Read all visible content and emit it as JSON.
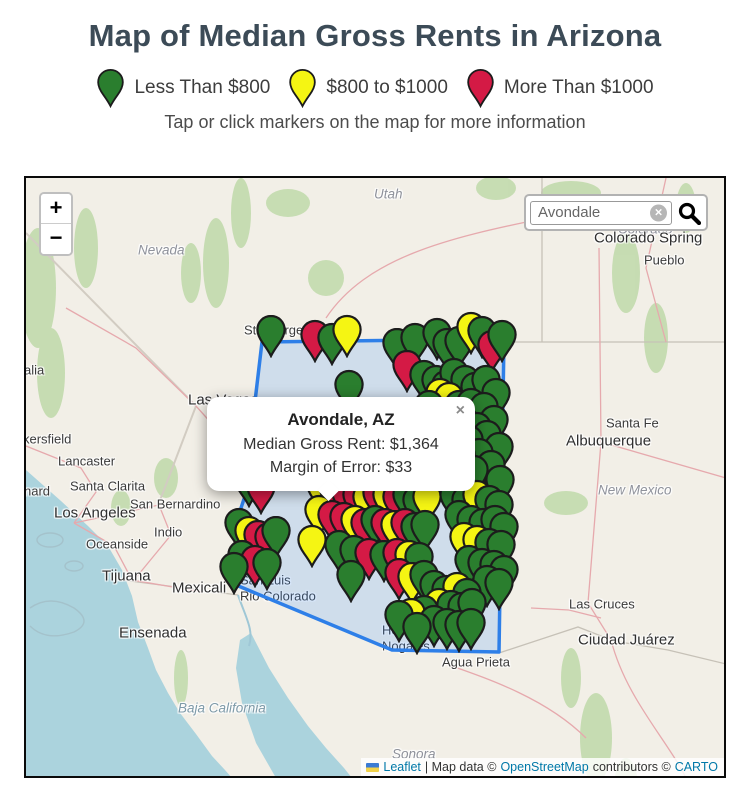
{
  "page": {
    "title": "Map of Median Gross Rents in Arizona",
    "subtitle": "Tap or click markers on the map for more information"
  },
  "legend": {
    "items": [
      {
        "label": "Less Than $800",
        "color": "#2a7e2e"
      },
      {
        "label": "$800 to $1000",
        "color": "#f5f513"
      },
      {
        "label": "More Than $1000",
        "color": "#d41a45"
      }
    ]
  },
  "map": {
    "controls": {
      "zoom_in": "+",
      "zoom_out": "−"
    },
    "search": {
      "value": "Avondale",
      "clear_icon": "×"
    },
    "popup": {
      "title": "Avondale, AZ",
      "line1": "Median Gross Rent: $1,364",
      "line2": "Margin of Error: $33",
      "close": "×"
    },
    "attribution": {
      "leaflet": "Leaflet",
      "map_data": "| Map data ©",
      "osm": "OpenStreetMap",
      "contributors": "contributors ©",
      "carto": "CARTO"
    },
    "boundary_color": "#2e7fe8",
    "marker_colors": {
      "g": "#2a7e2e",
      "y": "#f5f513",
      "r": "#d41a45"
    },
    "labels": [
      {
        "t": "Utah",
        "x": 348,
        "y": 16,
        "cls": "state"
      },
      {
        "t": "Nevada",
        "x": 112,
        "y": 72,
        "cls": "state"
      },
      {
        "t": "Colorado",
        "x": 592,
        "y": 51,
        "cls": "state"
      },
      {
        "t": "Colorado Spring",
        "x": 568,
        "y": 60,
        "cls": "citybig"
      },
      {
        "t": "Pueblo",
        "x": 618,
        "y": 82,
        "cls": "city"
      },
      {
        "t": "Santa Fe",
        "x": 580,
        "y": 245,
        "cls": "city"
      },
      {
        "t": "Albuquerque",
        "x": 540,
        "y": 263,
        "cls": "citybig"
      },
      {
        "t": "New Mexico",
        "x": 572,
        "y": 312,
        "cls": "state"
      },
      {
        "t": "Las Cruces",
        "x": 543,
        "y": 426,
        "cls": "city"
      },
      {
        "t": "Ciudad Juárez",
        "x": 552,
        "y": 462,
        "cls": "citybig"
      },
      {
        "t": "Agua Prieta",
        "x": 416,
        "y": 484,
        "cls": "city"
      },
      {
        "t": "Heroica",
        "x": 356,
        "y": 452,
        "cls": "city"
      },
      {
        "t": "Nogales",
        "x": 356,
        "y": 468,
        "cls": "city"
      },
      {
        "t": "San Luis",
        "x": 214,
        "y": 402,
        "cls": "city"
      },
      {
        "t": "Rio Colorado",
        "x": 214,
        "y": 418,
        "cls": "city"
      },
      {
        "t": "Mexicali",
        "x": 146,
        "y": 410,
        "cls": "citybig"
      },
      {
        "t": "Tijuana",
        "x": 76,
        "y": 398,
        "cls": "citybig"
      },
      {
        "t": "Ensenada",
        "x": 93,
        "y": 455,
        "cls": "citybig"
      },
      {
        "t": "Baja California",
        "x": 152,
        "y": 530,
        "cls": "area"
      },
      {
        "t": "Sonora",
        "x": 366,
        "y": 576,
        "cls": "state"
      },
      {
        "t": "Los Angeles",
        "x": 28,
        "y": 335,
        "cls": "citybig"
      },
      {
        "t": "San Bernardino",
        "x": 104,
        "y": 326,
        "cls": "city"
      },
      {
        "t": "Santa Clarita",
        "x": 44,
        "y": 308,
        "cls": "city"
      },
      {
        "t": "Lancaster",
        "x": 32,
        "y": 283,
        "cls": "city"
      },
      {
        "t": "kersfield",
        "x": -3,
        "y": 261,
        "cls": "city"
      },
      {
        "t": "nard",
        "x": -2,
        "y": 313,
        "cls": "city"
      },
      {
        "t": "Indio",
        "x": 128,
        "y": 354,
        "cls": "city"
      },
      {
        "t": "Oceanside",
        "x": 60,
        "y": 366,
        "cls": "city"
      },
      {
        "t": "alia",
        "x": -2,
        "y": 192,
        "cls": "city"
      },
      {
        "t": "Las Vegas",
        "x": 162,
        "y": 222,
        "cls": "citybig"
      },
      {
        "t": "St George",
        "x": 218,
        "y": 152,
        "cls": "city"
      }
    ],
    "markers": [
      [
        245,
        179,
        "g"
      ],
      [
        289,
        184,
        "r"
      ],
      [
        306,
        187,
        "g"
      ],
      [
        321,
        179,
        "y"
      ],
      [
        371,
        192,
        "g"
      ],
      [
        389,
        187,
        "g"
      ],
      [
        411,
        182,
        "g"
      ],
      [
        421,
        192,
        "g"
      ],
      [
        433,
        190,
        "g"
      ],
      [
        445,
        176,
        "y"
      ],
      [
        456,
        180,
        "g"
      ],
      [
        466,
        194,
        "r"
      ],
      [
        476,
        184,
        "g"
      ],
      [
        381,
        214,
        "r"
      ],
      [
        398,
        224,
        "g"
      ],
      [
        410,
        229,
        "g"
      ],
      [
        420,
        234,
        "g"
      ],
      [
        428,
        222,
        "g"
      ],
      [
        439,
        229,
        "g"
      ],
      [
        449,
        236,
        "g"
      ],
      [
        460,
        229,
        "g"
      ],
      [
        470,
        242,
        "g"
      ],
      [
        414,
        242,
        "y"
      ],
      [
        423,
        246,
        "y"
      ],
      [
        403,
        254,
        "g"
      ],
      [
        433,
        254,
        "g"
      ],
      [
        445,
        252,
        "g"
      ],
      [
        458,
        256,
        "g"
      ],
      [
        323,
        234,
        "g"
      ],
      [
        468,
        269,
        "g"
      ],
      [
        428,
        269,
        "g"
      ],
      [
        440,
        272,
        "g"
      ],
      [
        451,
        276,
        "g"
      ],
      [
        413,
        269,
        "g"
      ],
      [
        461,
        284,
        "g"
      ],
      [
        443,
        289,
        "g"
      ],
      [
        425,
        286,
        "g"
      ],
      [
        473,
        296,
        "g"
      ],
      [
        453,
        302,
        "g"
      ],
      [
        435,
        304,
        "g"
      ],
      [
        465,
        314,
        "g"
      ],
      [
        448,
        319,
        "g"
      ],
      [
        474,
        329,
        "g"
      ],
      [
        223,
        329,
        "g"
      ],
      [
        235,
        336,
        "r"
      ],
      [
        213,
        372,
        "g"
      ],
      [
        223,
        380,
        "y"
      ],
      [
        232,
        384,
        "r"
      ],
      [
        243,
        386,
        "r"
      ],
      [
        250,
        380,
        "g"
      ],
      [
        216,
        404,
        "g"
      ],
      [
        229,
        409,
        "r"
      ],
      [
        241,
        412,
        "g"
      ],
      [
        208,
        416,
        "g"
      ],
      [
        303,
        319,
        "g"
      ],
      [
        315,
        316,
        "r"
      ],
      [
        325,
        322,
        "r"
      ],
      [
        335,
        324,
        "r"
      ],
      [
        343,
        329,
        "r"
      ],
      [
        353,
        322,
        "g"
      ],
      [
        363,
        326,
        "r"
      ],
      [
        373,
        322,
        "y"
      ],
      [
        383,
        329,
        "g"
      ],
      [
        391,
        324,
        "g"
      ],
      [
        401,
        322,
        "r"
      ],
      [
        411,
        329,
        "g"
      ],
      [
        295,
        334,
        "y"
      ],
      [
        308,
        339,
        "r"
      ],
      [
        320,
        342,
        "r"
      ],
      [
        331,
        344,
        "r"
      ],
      [
        341,
        346,
        "y"
      ],
      [
        351,
        342,
        "r"
      ],
      [
        361,
        344,
        "y"
      ],
      [
        371,
        346,
        "r"
      ],
      [
        381,
        344,
        "g"
      ],
      [
        391,
        349,
        "g"
      ],
      [
        401,
        346,
        "y"
      ],
      [
        293,
        359,
        "y"
      ],
      [
        306,
        364,
        "r"
      ],
      [
        318,
        366,
        "r"
      ],
      [
        329,
        369,
        "y"
      ],
      [
        339,
        372,
        "r"
      ],
      [
        349,
        369,
        "g"
      ],
      [
        359,
        372,
        "r"
      ],
      [
        369,
        374,
        "y"
      ],
      [
        379,
        372,
        "r"
      ],
      [
        389,
        376,
        "g"
      ],
      [
        399,
        374,
        "g"
      ],
      [
        286,
        389,
        "y"
      ],
      [
        313,
        394,
        "g"
      ],
      [
        328,
        399,
        "g"
      ],
      [
        343,
        402,
        "r"
      ],
      [
        358,
        404,
        "g"
      ],
      [
        371,
        402,
        "r"
      ],
      [
        383,
        404,
        "y"
      ],
      [
        393,
        406,
        "g"
      ],
      [
        325,
        424,
        "g"
      ],
      [
        373,
        422,
        "r"
      ],
      [
        386,
        426,
        "y"
      ],
      [
        398,
        424,
        "g"
      ],
      [
        428,
        344,
        "g"
      ],
      [
        440,
        349,
        "g"
      ],
      [
        451,
        344,
        "y"
      ],
      [
        463,
        349,
        "g"
      ],
      [
        473,
        354,
        "g"
      ],
      [
        433,
        364,
        "g"
      ],
      [
        445,
        369,
        "g"
      ],
      [
        457,
        372,
        "g"
      ],
      [
        469,
        369,
        "g"
      ],
      [
        478,
        376,
        "g"
      ],
      [
        438,
        386,
        "y"
      ],
      [
        451,
        389,
        "y"
      ],
      [
        463,
        392,
        "g"
      ],
      [
        475,
        394,
        "g"
      ],
      [
        443,
        409,
        "g"
      ],
      [
        456,
        412,
        "g"
      ],
      [
        468,
        414,
        "g"
      ],
      [
        478,
        419,
        "g"
      ],
      [
        461,
        429,
        "g"
      ],
      [
        473,
        432,
        "g"
      ],
      [
        408,
        434,
        "g"
      ],
      [
        420,
        439,
        "g"
      ],
      [
        431,
        436,
        "y"
      ],
      [
        441,
        442,
        "g"
      ],
      [
        413,
        452,
        "y"
      ],
      [
        425,
        454,
        "g"
      ],
      [
        436,
        456,
        "g"
      ],
      [
        446,
        452,
        "g"
      ],
      [
        398,
        459,
        "g"
      ],
      [
        385,
        462,
        "y"
      ],
      [
        373,
        464,
        "g"
      ],
      [
        408,
        469,
        "g"
      ],
      [
        421,
        472,
        "g"
      ],
      [
        433,
        474,
        "g"
      ],
      [
        445,
        472,
        "g"
      ],
      [
        391,
        476,
        "g"
      ]
    ]
  }
}
